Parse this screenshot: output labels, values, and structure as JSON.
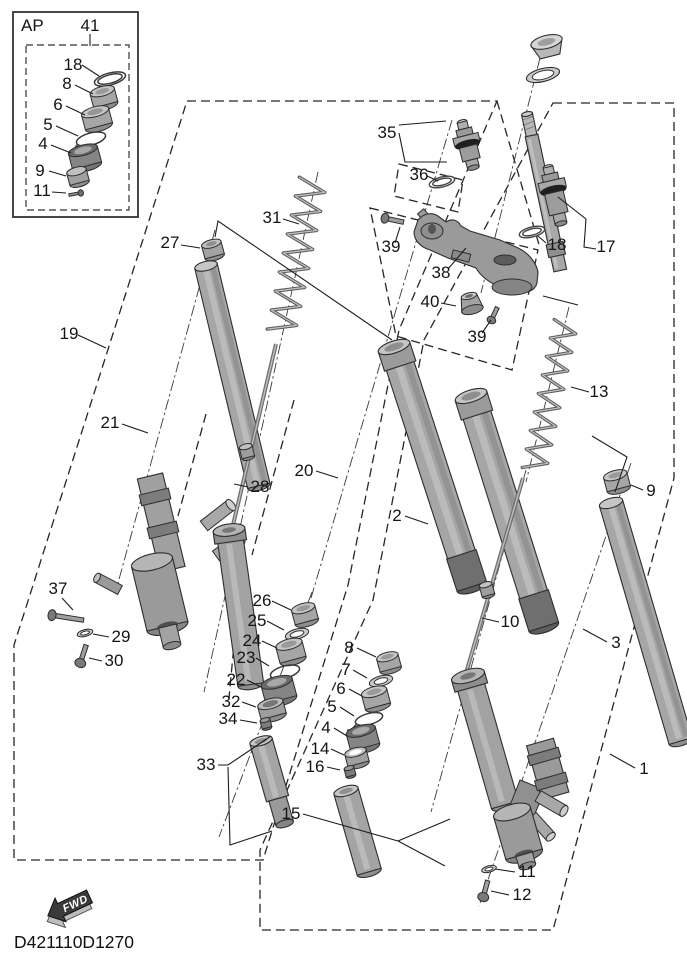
{
  "diagram": {
    "code": "D421110D1270",
    "ap_label": "AP",
    "fwd_label": "FWD",
    "title": "Front fork exploded parts diagram"
  },
  "callouts": {
    "c41": "41",
    "c18a": "18",
    "c8a": "8",
    "c6a": "6",
    "c5a": "5",
    "c4a": "4",
    "c9a": "9",
    "c11a": "11",
    "c35": "35",
    "c36": "36",
    "c17": "17",
    "c18b": "18",
    "c39a": "39",
    "c38": "38",
    "c40": "40",
    "c39b": "39",
    "c19": "19",
    "c27": "27",
    "c31": "31",
    "c21": "21",
    "c28": "28",
    "c20": "20",
    "c2": "2",
    "c13": "13",
    "c37": "37",
    "c29": "29",
    "c30": "30",
    "c26": "26",
    "c25": "25",
    "c24": "24",
    "c23": "23",
    "c22": "22",
    "c32": "32",
    "c34": "34",
    "c33": "33",
    "c8b": "8",
    "c7": "7",
    "c6b": "6",
    "c5b": "5",
    "c4b": "4",
    "c14": "14",
    "c16": "16",
    "c15": "15",
    "c9b": "9",
    "c3": "3",
    "c10": "10",
    "c1": "1",
    "c11b": "11",
    "c12": "12"
  }
}
